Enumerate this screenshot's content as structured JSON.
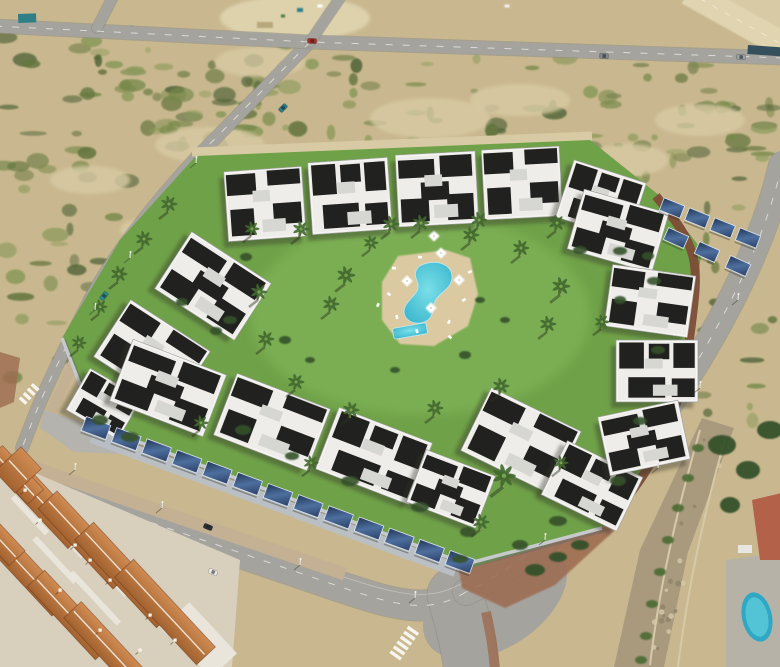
{
  "scene": {
    "name": "aerial-view-modern-residential-complex",
    "setting": "drone photo of a new-build white apartment complex with central lawn and pool, solar carports along the perimeter wall, surrounded by sandy scrubland, roads, and an older terracotta-roof village at lower left"
  },
  "palette": {
    "sand": "#c9b88f",
    "sandLight": "#d8caa4",
    "sandPale": "#e0d5b0",
    "scrub1": "#77894c",
    "scrub2": "#65763f",
    "scrub3": "#8b9a5c",
    "scrub4": "#55663a",
    "road": "#a5a39d",
    "roadLight": "#b2b0aa",
    "roadDark": "#8f8d88",
    "lawn": "#6fa148",
    "lawnLight": "#85b95c",
    "deck": "#dbc9a2",
    "poolWater": "#58c5d8",
    "poolDeep": "#2fa8c4",
    "bldgWhite": "#eeedea",
    "bldgShade": "#d6d6d2",
    "bldgDark": "#21211f",
    "solarA": "#223657",
    "solarB": "#4d6f9e",
    "frame": "#dde4ec",
    "carportBand": "#b9bfc6",
    "terraA": "#cf8b52",
    "terraB": "#a2622f",
    "ridge": "#f3efe6",
    "villageBase": "#d8d0bd",
    "villageWall": "#eae6dc",
    "wallBrown": "#7d4c38",
    "wallGrey": "#c6cacc",
    "pave": "#c4b193",
    "paveRed": "#9c6a50",
    "ditch": "#a99a7e",
    "hedge": "#4a6a33",
    "stone": "#d6c9a8",
    "stoneDark": "#8f8268",
    "shadow": "rgba(45,52,38,0.38)",
    "treeDark": "#35512b",
    "palmGreen": "#41682f",
    "palmLight": "#79a24e",
    "trunk": "#b5a37f",
    "white": "#ffffff",
    "container": "#2e7f86",
    "barrier": "#33505c",
    "propRed": "#b4614a",
    "propDeck": "#b7b2a8"
  },
  "ground": {
    "fields": [
      {
        "x": 0,
        "y": 30,
        "w": 310,
        "h": 118,
        "n": 48,
        "seed": 7
      },
      {
        "x": 0,
        "y": 148,
        "w": 150,
        "h": 230,
        "n": 34,
        "seed": 11
      },
      {
        "x": 310,
        "y": 55,
        "w": 290,
        "h": 100,
        "n": 30,
        "seed": 13
      },
      {
        "x": 560,
        "y": 60,
        "w": 220,
        "h": 160,
        "n": 36,
        "seed": 17
      },
      {
        "x": 650,
        "y": 220,
        "w": 130,
        "h": 210,
        "n": 26,
        "seed": 19
      },
      {
        "x": 0,
        "y": 95,
        "w": 780,
        "h": 60,
        "n": 20,
        "seed": 23
      },
      {
        "x": 150,
        "y": 60,
        "w": 160,
        "h": 95,
        "n": 18,
        "seed": 29
      }
    ],
    "sandBlobs": [
      [
        210,
        145,
        55,
        18
      ],
      [
        350,
        195,
        75,
        26
      ],
      [
        430,
        118,
        60,
        20
      ],
      [
        260,
        62,
        45,
        15
      ],
      [
        600,
        300,
        55,
        20
      ],
      [
        700,
        120,
        45,
        16
      ],
      [
        160,
        230,
        40,
        14
      ],
      [
        520,
        100,
        50,
        16
      ],
      [
        660,
        380,
        40,
        14
      ],
      [
        90,
        180,
        40,
        14
      ],
      [
        628,
        160,
        40,
        16
      ]
    ],
    "dirtLot": [
      295,
      18,
      75,
      22
    ],
    "specks": [
      [
        300,
        10,
        6,
        4,
        "#2f7f8b"
      ],
      [
        320,
        6,
        5,
        3,
        "#ffffff"
      ],
      [
        283,
        16,
        4,
        3,
        "#3f7f3f"
      ],
      [
        507,
        6,
        5,
        3,
        "#f0f0ec"
      ],
      [
        265,
        25,
        16,
        6,
        "#b9a87e"
      ]
    ]
  },
  "roads": {
    "top": "M-5,26 L310,42 L785,58",
    "stubUp": "M310,42 L342,-5",
    "stubLeft": "M97,28 L114,-5",
    "diagonal": "M310,42 L196,158 C150,208 112,258 92,296 C70,338 50,378 36,412 L22,448",
    "boulevard": "M-10,468 C120,512 250,556 338,586 C400,607 430,614 466,592",
    "rightRoad": "M782,165 C760,260 706,352 660,418 C614,484 540,556 466,592",
    "bottomExit": "M455,595 C465,630 470,650 472,675",
    "widths": {
      "top": 13,
      "stub": 10,
      "diagonal": 12,
      "boulevard": 30,
      "rightRoad": 26,
      "bottomExit": 55
    },
    "junctionPad": [
      495,
      600,
      80,
      48,
      -33
    ],
    "dashed": [
      "top",
      "boulevard",
      "rightRoad",
      "diagonal"
    ],
    "crosswalks": [
      {
        "x": 405,
        "y": 642,
        "rot": -55,
        "n": 6,
        "len": 13
      },
      {
        "x": 30,
        "y": 393,
        "rot": -48,
        "n": 4,
        "len": 9
      }
    ]
  },
  "paving": {
    "sidewalkVillage": {
      "d": "M-10,452 C120,498 250,542 345,574",
      "w": 13
    },
    "westSidewalk": {
      "d": "M208,166 C165,214 130,260 106,300 C86,338 66,378 50,414",
      "w": 11
    },
    "northPath": {
      "d": "M192,152 L592,136",
      "w": 9
    },
    "redPaveSE": "455,545 585,518 615,530 555,585 505,608 462,588",
    "redPaveWest": "0,352 20,358 14,402 0,408",
    "redPaveExit": {
      "d": "M486,612 C492,640 494,655 495,672",
      "w": 10
    },
    "apron": "44,410 100,428 122,454 74,452 40,428",
    "ditch": {
      "poly": "702,418 734,428 688,552 664,667 614,667 640,550",
      "wall1": "M700,430 C680,500 660,580 650,665",
      "wall2": "M726,436 C706,505 688,585 678,667",
      "stonesN": 26,
      "seed": 31
    }
  },
  "village": {
    "base": "0,458 240,560 232,667 0,667",
    "roofs": [
      [
        45,
        505,
        95,
        26,
        47
      ],
      [
        85,
        540,
        110,
        26,
        47
      ],
      [
        125,
        575,
        120,
        26,
        47
      ],
      [
        165,
        612,
        120,
        26,
        47
      ],
      [
        30,
        575,
        90,
        24,
        47
      ],
      [
        70,
        615,
        100,
        24,
        47
      ],
      [
        15,
        475,
        60,
        22,
        47
      ],
      [
        110,
        650,
        110,
        24,
        47
      ],
      [
        0,
        540,
        50,
        22,
        47
      ],
      [
        18,
        470,
        30,
        36,
        47
      ]
    ],
    "walls": [
      [
        60,
        530,
        70,
        8,
        47
      ],
      [
        100,
        565,
        80,
        8,
        47
      ],
      [
        140,
        600,
        85,
        8,
        47
      ],
      [
        55,
        560,
        60,
        6,
        47
      ],
      [
        95,
        598,
        70,
        6,
        47
      ],
      [
        180,
        635,
        70,
        8,
        47
      ],
      [
        30,
        515,
        50,
        6,
        47
      ],
      [
        200,
        640,
        70,
        36,
        47
      ]
    ],
    "chimneys": [
      [
        40,
        520
      ],
      [
        75,
        545
      ],
      [
        110,
        580
      ],
      [
        150,
        615
      ],
      [
        60,
        590
      ],
      [
        100,
        630
      ],
      [
        25,
        490
      ],
      [
        140,
        650
      ],
      [
        175,
        640
      ],
      [
        90,
        560
      ]
    ]
  },
  "complex": {
    "lawn": "196,156 590,140 660,196 702,250 688,340 645,480 602,528 470,568 96,426 62,338 120,240",
    "lawnHighlight": [
      420,
      315,
      170,
      100
    ],
    "wallGrey": "M62,338 L96,426 L466,564 L602,528",
    "wallBrown": "M656,196 C700,250 700,260 690,335 C680,415 660,460 612,516",
    "buildings": [
      [
        265,
        204,
        78,
        70,
        -4
      ],
      [
        350,
        196,
        80,
        72,
        -4
      ],
      [
        437,
        189,
        80,
        72,
        -3
      ],
      [
        522,
        183,
        78,
        70,
        -3
      ],
      [
        601,
        200,
        76,
        60,
        18
      ],
      [
        213,
        286,
        95,
        68,
        33
      ],
      [
        152,
        354,
        95,
        68,
        33
      ],
      [
        104,
        404,
        60,
        48,
        30
      ],
      [
        168,
        388,
        100,
        66,
        21
      ],
      [
        272,
        422,
        100,
        66,
        21
      ],
      [
        374,
        456,
        100,
        66,
        21
      ],
      [
        451,
        489,
        74,
        56,
        21
      ],
      [
        521,
        441,
        100,
        70,
        26
      ],
      [
        592,
        486,
        84,
        60,
        26
      ],
      [
        618,
        231,
        88,
        62,
        16
      ],
      [
        650,
        301,
        84,
        62,
        8
      ],
      [
        657,
        371,
        82,
        62,
        0
      ],
      [
        644,
        438,
        82,
        60,
        -12
      ]
    ],
    "carportBand": {
      "d": "M92,436 L456,570",
      "w": 14
    },
    "carportRows": [
      {
        "x1": 96,
        "y1": 428,
        "x2": 460,
        "y2": 562,
        "n": 13,
        "pw": 26,
        "ph": 15
      },
      {
        "x1": 672,
        "y1": 208,
        "x2": 748,
        "y2": 238,
        "n": 4,
        "pw": 22,
        "ph": 13
      },
      {
        "x1": 676,
        "y1": 238,
        "x2": 738,
        "y2": 266,
        "n": 3,
        "pw": 22,
        "ph": 13
      }
    ]
  },
  "pool": {
    "deck": "398,256 446,250 470,258 478,294 468,326 434,346 400,344 382,320 382,282",
    "main": "M424,264 C440,259 452,266 452,277 C452,287 443,291 437,298 C431,305 435,313 429,319 C420,327 405,323 404,312 C404,303 413,298 417,291 C421,283 413,278 416,271 C418,266 420,266 424,264 Z",
    "kiddie": [
      410,
      331,
      34,
      11,
      -10
    ],
    "umbrellas": [
      [
        407,
        281
      ],
      [
        459,
        280
      ],
      [
        431,
        308
      ],
      [
        441,
        253
      ],
      [
        434,
        236
      ]
    ],
    "loungers": [
      [
        394,
        268
      ],
      [
        389,
        294
      ],
      [
        417,
        331
      ],
      [
        449,
        322
      ],
      [
        464,
        300
      ],
      [
        420,
        257
      ],
      [
        450,
        337
      ],
      [
        397,
        317
      ],
      [
        378,
        305
      ],
      [
        470,
        272
      ]
    ]
  },
  "vegetation": {
    "palms": [
      [
        168,
        212,
        1
      ],
      [
        143,
        247,
        1
      ],
      [
        118,
        282,
        1
      ],
      [
        99,
        314,
        0.9
      ],
      [
        78,
        350,
        0.9
      ],
      [
        300,
        237,
        1
      ],
      [
        390,
        232,
        1
      ],
      [
        478,
        228,
        1
      ],
      [
        556,
        231,
        1
      ],
      [
        251,
        236,
        0.9
      ],
      [
        345,
        284,
        1.1
      ],
      [
        330,
        312,
        1
      ],
      [
        420,
        231,
        1
      ],
      [
        470,
        243,
        1
      ],
      [
        520,
        256,
        1
      ],
      [
        560,
        295,
        1.1
      ],
      [
        547,
        332,
        1
      ],
      [
        500,
        394,
        1
      ],
      [
        434,
        416,
        1
      ],
      [
        350,
        418,
        1
      ],
      [
        295,
        390,
        1
      ],
      [
        265,
        347,
        1
      ],
      [
        258,
        300,
        1
      ],
      [
        601,
        329,
        0.9
      ],
      [
        370,
        250,
        0.9
      ],
      [
        503,
        487,
        1.4
      ],
      [
        480,
        530,
        1
      ],
      [
        560,
        470,
        0.9
      ],
      [
        200,
        430,
        0.9
      ],
      [
        310,
        470,
        0.9
      ]
    ],
    "bushes": [
      [
        100,
        420,
        8,
        5
      ],
      [
        130,
        437,
        9,
        5
      ],
      [
        230,
        320,
        7,
        4
      ],
      [
        243,
        430,
        8,
        5
      ],
      [
        350,
        481,
        9,
        5
      ],
      [
        420,
        507,
        9,
        5
      ],
      [
        468,
        532,
        8,
        5
      ],
      [
        558,
        521,
        9,
        5
      ],
      [
        618,
        481,
        8,
        5
      ],
      [
        640,
        421,
        7,
        4
      ],
      [
        658,
        350,
        7,
        4
      ],
      [
        654,
        281,
        7,
        4
      ],
      [
        620,
        251,
        7,
        4
      ],
      [
        580,
        250,
        7,
        4
      ],
      [
        246,
        257,
        6,
        4
      ],
      [
        216,
        331,
        6,
        4
      ],
      [
        460,
        559,
        8,
        4
      ],
      [
        182,
        302,
        6,
        4
      ],
      [
        292,
        456,
        7,
        4
      ],
      [
        520,
        545,
        8,
        5
      ],
      [
        285,
        340,
        6,
        4
      ],
      [
        310,
        360,
        5,
        3
      ],
      [
        480,
        300,
        5,
        3
      ],
      [
        505,
        320,
        5,
        3
      ],
      [
        465,
        355,
        6,
        4
      ],
      [
        395,
        370,
        5,
        3
      ],
      [
        620,
        300,
        6,
        4
      ],
      [
        648,
        256,
        6,
        4
      ]
    ],
    "seTrees": [
      [
        535,
        570,
        10,
        6
      ],
      [
        558,
        557,
        9,
        5
      ],
      [
        580,
        545,
        9,
        5
      ],
      [
        722,
        445,
        14,
        10
      ],
      [
        748,
        470,
        12,
        9
      ],
      [
        770,
        430,
        13,
        9
      ],
      [
        730,
        505,
        10,
        8
      ]
    ],
    "ditchHedges": [
      [
        698,
        448
      ],
      [
        688,
        478
      ],
      [
        678,
        508
      ],
      [
        668,
        540
      ],
      [
        660,
        572
      ],
      [
        652,
        604
      ],
      [
        646,
        636
      ],
      [
        641,
        660
      ]
    ]
  },
  "objects": {
    "cars": [
      [
        312,
        41,
        3,
        "#ab2e26"
      ],
      [
        604,
        56,
        4,
        "#83878b"
      ],
      [
        741,
        57,
        4,
        "#9aa0a4"
      ],
      [
        283,
        108,
        -45,
        "#2f7f8b"
      ],
      [
        104,
        296,
        -50,
        "#2b8a90"
      ],
      [
        208,
        527,
        22,
        "#2c3034"
      ],
      [
        213,
        572,
        22,
        "#eceae6"
      ]
    ],
    "lamps": [
      [
        75,
        470
      ],
      [
        162,
        508
      ],
      [
        300,
        565
      ],
      [
        415,
        598
      ],
      [
        658,
        468
      ],
      [
        700,
        388
      ],
      [
        738,
        300
      ],
      [
        130,
        258
      ],
      [
        95,
        310
      ],
      [
        196,
        163
      ],
      [
        545,
        540
      ]
    ],
    "container": [
      18,
      14,
      18,
      9,
      -2
    ],
    "barrier": [
      748,
      45,
      34,
      9,
      4
    ],
    "highway": {
      "band": "M688,-8 L792,50",
      "width": 26,
      "embankment": "700,-5 790,-5 790,45"
    },
    "propertySE": {
      "deck": "726,560 786,552 786,667 726,667",
      "pool": [
        757,
        617,
        15,
        25,
        -12
      ],
      "building": "752,500 786,492 786,560 760,560",
      "whiteBit": [
        738,
        545,
        14,
        8
      ]
    }
  }
}
